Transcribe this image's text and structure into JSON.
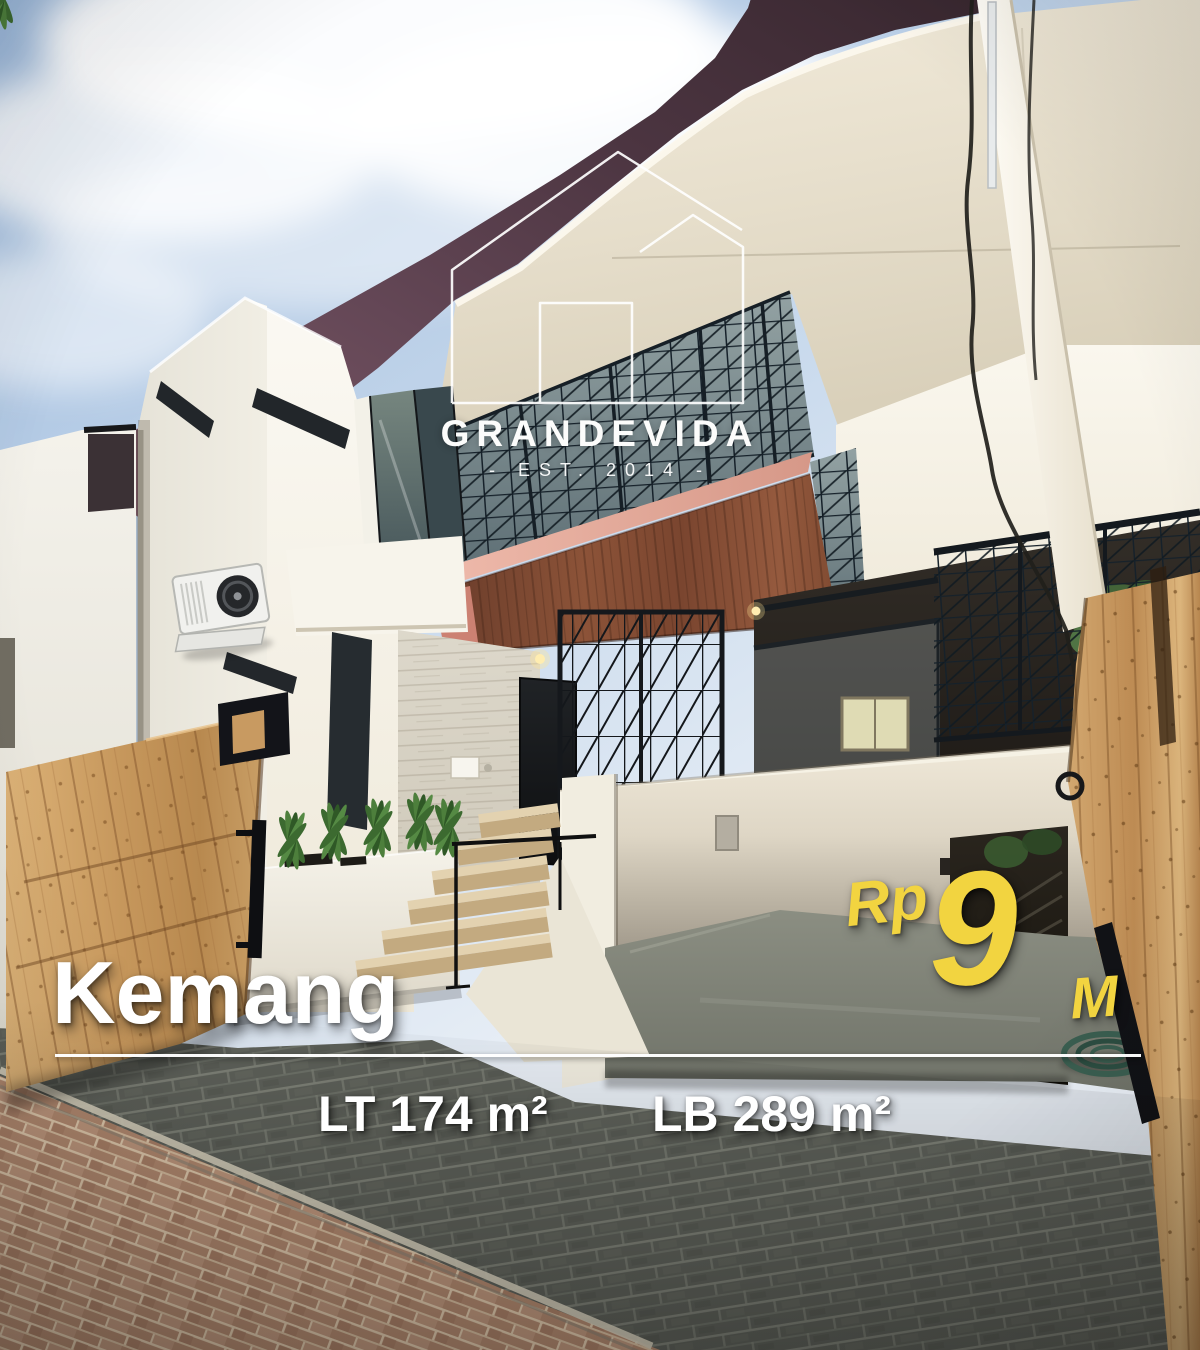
{
  "post": {
    "type": "property-listing-photo"
  },
  "brand": {
    "name": "GRANDEVIDA",
    "established": "- EST. 2014 -",
    "mark_icon": "house-outline-icon"
  },
  "listing": {
    "location": "Kemang",
    "price": {
      "currency": "Rp",
      "amount": "9",
      "unit": "M"
    },
    "specs": [
      {
        "label": "LT",
        "value": "174",
        "unit": "m²",
        "text": "LT 174 m²"
      },
      {
        "label": "LB",
        "value": "289",
        "unit": "m²",
        "text": "LB 289 m²"
      }
    ]
  },
  "colors": {
    "price_yellow": "#F2D440",
    "overlay_white": "#FFFFFF",
    "roof_maroon": "#5E4250",
    "soffit_cream": "#EEE6D4",
    "gate_wood": "#C79A5F",
    "balcony_wood": "#7C4732",
    "lattice_steel": "#18232B"
  }
}
